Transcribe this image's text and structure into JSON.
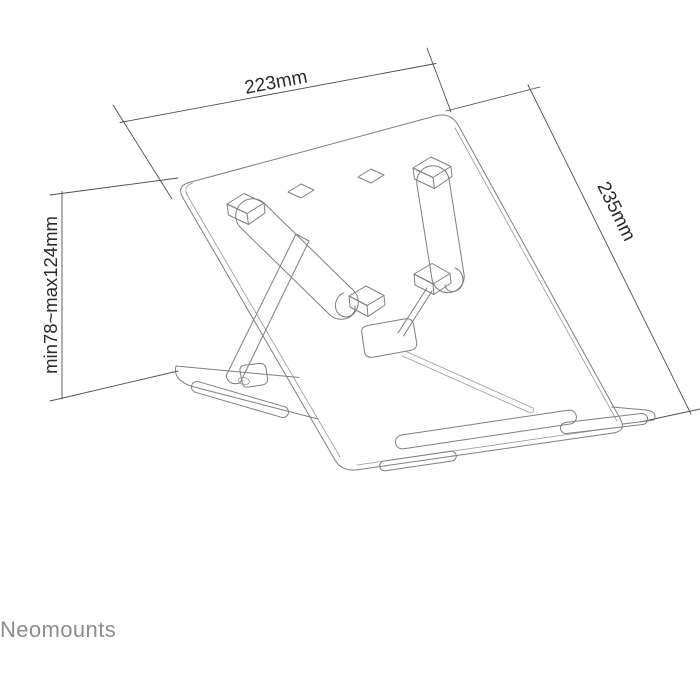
{
  "diagram": {
    "title": "laptop-stand-dimension-diagram",
    "dimensions": {
      "width_label": "223mm",
      "depth_label": "235mm",
      "height_label": "min78~max124mm"
    },
    "brand": "Neomounts",
    "colors": {
      "background": "#ffffff",
      "product_line": "#7f7f7f",
      "dimension_line": "#4f4f4f",
      "dimension_text": "#2b2b2b",
      "brand_text": "#8d8d8d"
    }
  }
}
